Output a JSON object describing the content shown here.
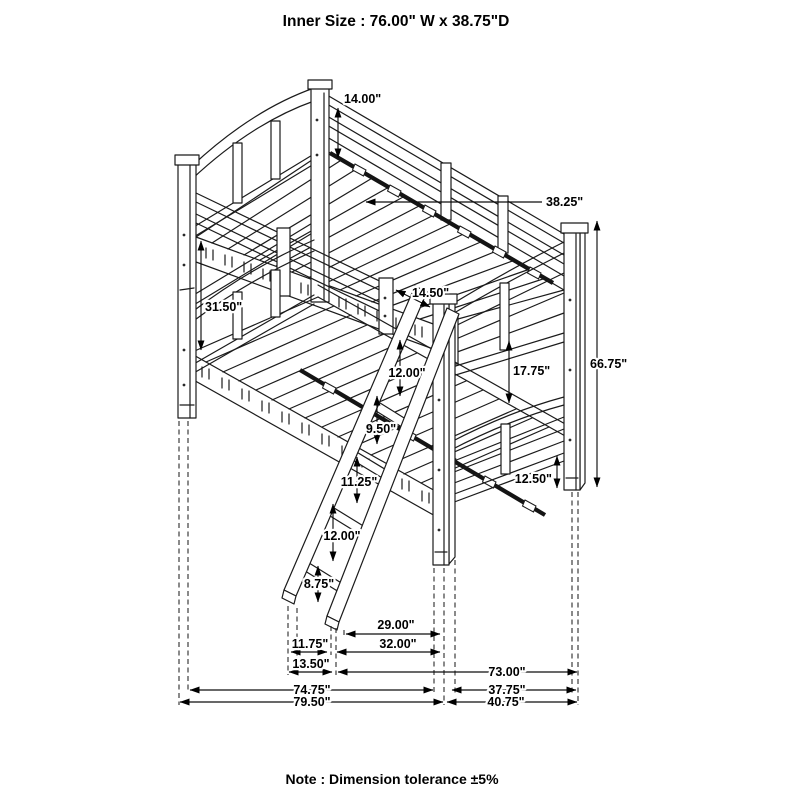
{
  "title": "Inner Size : 76.00\" W x  38.75\"D",
  "note": "Note : Dimension tolerance ±5%",
  "dims": {
    "headboard_rail_height": "14.00\"",
    "bunk_depth": "38.25\"",
    "bunk_clearance": "31.50\"",
    "ladder_opening": "14.50\"",
    "deck_to_rung1": "12.00\"",
    "rung1_to_rung2": "9.50\"",
    "rung2_to_rung3": "11.25\"",
    "rung3_to_rung4": "12.00\"",
    "rung4_to_floor": "8.75\"",
    "upper_to_lower_gap": "17.75\"",
    "overall_height": "66.75\"",
    "under_bed_clearance": "12.50\"",
    "ladder_to_leg": "29.00\"",
    "ladder_feet_inner": "11.75\"",
    "ladder_to_leg_outer": "32.00\"",
    "ladder_feet_outer": "13.50\"",
    "frame_length": "73.00\"",
    "floor_length_inner": "74.75\"",
    "end_depth_inner": "37.75\"",
    "overall_length": "79.50\"",
    "end_depth_overall": "40.75\""
  }
}
